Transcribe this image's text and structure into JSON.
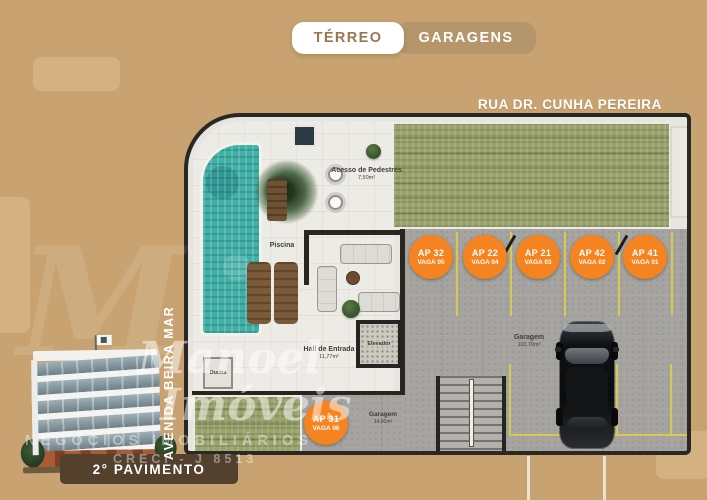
{
  "tabs": {
    "terreo": "TÉRREO",
    "garagens": "GARAGENS"
  },
  "streets": {
    "top": "RUA DR. CUNHA PEREIRA",
    "left": "AVENIDA BEIRA MAR"
  },
  "rooms": {
    "acesso": {
      "name": "Acesso de Pedestres",
      "area": "7,50m²"
    },
    "piscina": {
      "name": "Piscina"
    },
    "ducha": {
      "name": "Ducha"
    },
    "hall": {
      "name": "Hall de Entrada",
      "area": "11,77m²"
    },
    "elevador": {
      "name": "Elevador"
    },
    "garagem_grande": {
      "name": "Garagem",
      "area": "110,70m²"
    },
    "garagem_pequena": {
      "name": "Garagem",
      "area": "14,00m²"
    }
  },
  "parking_spots": [
    {
      "ap": "AP 32",
      "vaga": "VAGA 05"
    },
    {
      "ap": "AP 22",
      "vaga": "VAGA 04"
    },
    {
      "ap": "AP 21",
      "vaga": "VAGA 03"
    },
    {
      "ap": "AP 42",
      "vaga": "VAGA 02"
    },
    {
      "ap": "AP 41",
      "vaga": "VAGA 01"
    }
  ],
  "parking_spot_bottom": {
    "ap": "AP 31",
    "vaga": "VAGA 06"
  },
  "watermark": {
    "monogram": "M",
    "brand_line1": "Manoel",
    "brand_line2": "Imóveis",
    "tagline": "NEGÓCIOS IMOBILIÁRIOS",
    "creci": "CRECI - J 8513"
  },
  "footer": {
    "floor_label": "2° PAVIMENTO"
  },
  "colors": {
    "background": "#c8a371",
    "tab_active_bg": "#ffffff",
    "tab_active_text": "#97774e",
    "tab_inactive_bg": "#b5966b",
    "accent_orange": "#f5831f",
    "pool_teal": "#41b0a6",
    "hatch_green": "#9aa36c",
    "line_yellow": "#d8c94f",
    "footer_pill_brown": "#53412d"
  }
}
